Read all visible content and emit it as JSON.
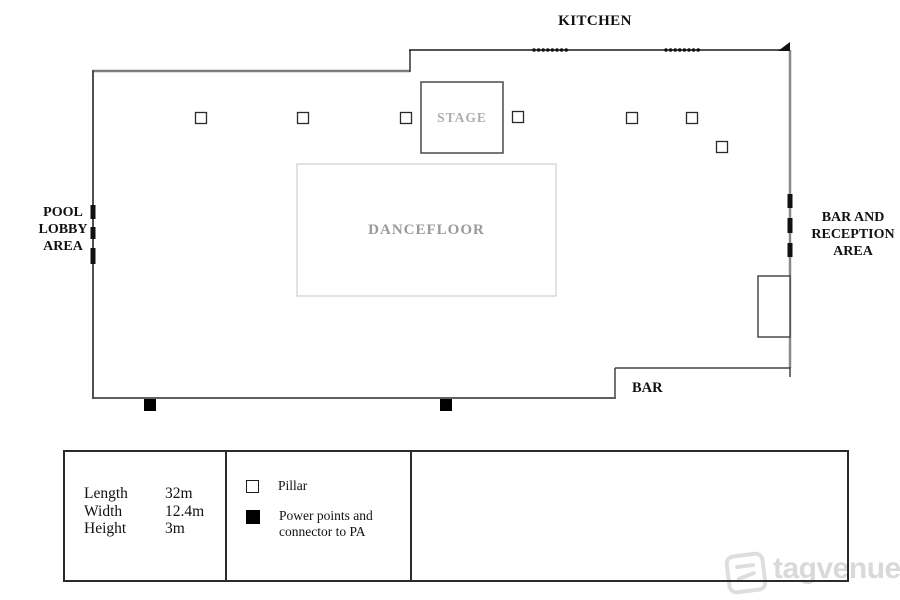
{
  "plan": {
    "labels": {
      "kitchen": "KITCHEN",
      "pool_lobby": [
        "POOL",
        "LOBBY",
        "AREA"
      ],
      "bar_reception": [
        "BAR AND",
        "RECEPTION",
        "AREA"
      ],
      "bar": "BAR",
      "stage": "STAGE",
      "dancefloor": "DANCEFLOOR"
    },
    "geometry": {
      "walls": [
        {
          "x1": 93,
          "y1": 71,
          "x2": 410,
          "y2": 71,
          "c": "#7d7d7d",
          "w": 2.5
        },
        {
          "x1": 410,
          "y1": 72,
          "x2": 410,
          "y2": 50,
          "c": "#333333",
          "w": 1.5
        },
        {
          "x1": 409,
          "y1": 50,
          "x2": 790,
          "y2": 50,
          "c": "#1a1a1a",
          "w": 1.4
        },
        {
          "x1": 790,
          "y1": 50,
          "x2": 790,
          "y2": 368,
          "c": "#8a8a8a",
          "w": 2.5
        },
        {
          "x1": 791,
          "y1": 368,
          "x2": 615,
          "y2": 368,
          "c": "#444444",
          "w": 1.5
        },
        {
          "x1": 790,
          "y1": 368,
          "x2": 790,
          "y2": 377,
          "c": "#444444",
          "w": 1.5
        },
        {
          "x1": 615,
          "y1": 368,
          "x2": 615,
          "y2": 398,
          "c": "#444444",
          "w": 1.5
        },
        {
          "x1": 616,
          "y1": 398,
          "x2": 93,
          "y2": 398,
          "c": "#606060",
          "w": 2
        },
        {
          "x1": 93,
          "y1": 399,
          "x2": 93,
          "y2": 70,
          "c": "#3d3d3d",
          "w": 1.8
        }
      ],
      "stage_box": {
        "x": 421,
        "y": 82,
        "w": 82,
        "h": 71
      },
      "dancefloor_box": {
        "x": 297,
        "y": 164,
        "w": 259,
        "h": 132
      },
      "bar_counter_box": {
        "x": 758,
        "y": 276,
        "w": 32,
        "h": 61
      },
      "pillars": {
        "size": 11,
        "centers": [
          [
            201,
            118
          ],
          [
            303,
            118
          ],
          [
            406,
            118
          ],
          [
            518,
            117
          ],
          [
            632,
            118
          ],
          [
            692,
            118
          ],
          [
            722,
            147
          ]
        ]
      },
      "power_points": {
        "size": 12,
        "centers": [
          [
            150,
            405
          ],
          [
            446,
            405
          ]
        ]
      },
      "door_dashes": [
        {
          "x": 93,
          "segments": [
            [
              205,
              219
            ],
            [
              227,
              239
            ],
            [
              248,
              264
            ]
          ]
        },
        {
          "x": 790,
          "segments": [
            [
              194,
              208
            ],
            [
              218,
              233
            ],
            [
              243,
              257
            ]
          ]
        }
      ],
      "wall_dots": {
        "y": 50,
        "r": 1.8,
        "spacing": 4.6,
        "groups": [
          {
            "start": 534,
            "count": 8
          },
          {
            "start": 666,
            "count": 8
          }
        ]
      },
      "corner_arrow": "778,51 790,42 790,51"
    }
  },
  "legend": {
    "dimensions": [
      {
        "label": "Length",
        "value": "32m"
      },
      {
        "label": "Width",
        "value": "12.4m"
      },
      {
        "label": "Height",
        "value": "3m"
      }
    ],
    "symbols": [
      {
        "icon": "pillar-square-outline",
        "lines": [
          "Pillar",
          ""
        ]
      },
      {
        "icon": "power-point-square-filled",
        "lines": [
          "Power points and",
          "connector to PA"
        ]
      }
    ]
  },
  "watermark": {
    "brand": "tagvenue"
  }
}
